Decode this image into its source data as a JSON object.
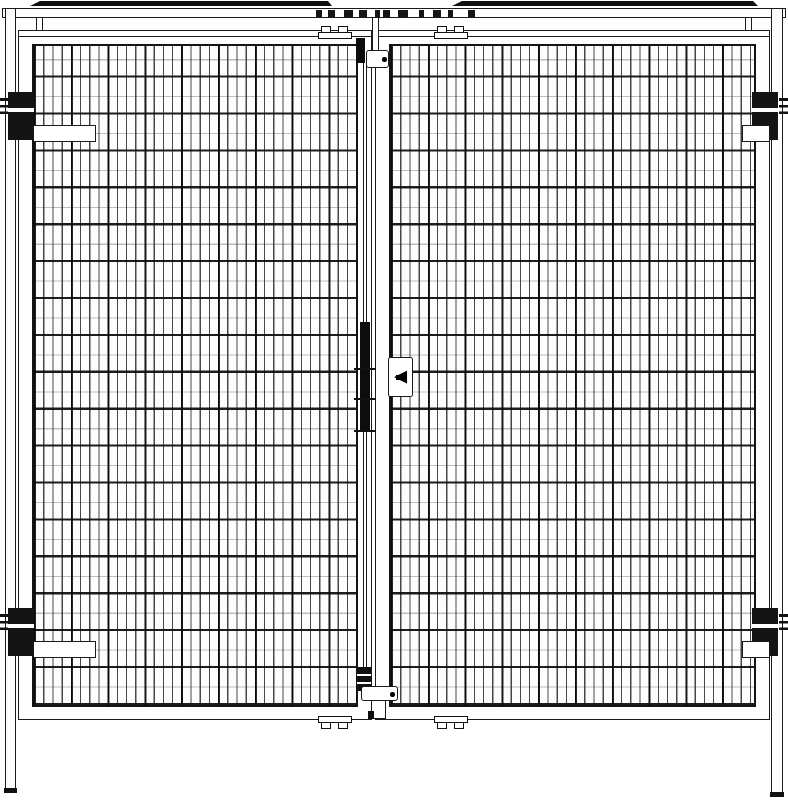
{
  "document": {
    "type": "technical-drawing",
    "subject": "Double-leaf wire mesh safety gate, front elevation",
    "background_color": "#ffffff",
    "line_color": "#1a1a1a",
    "hardware_color": "#111111"
  },
  "annotations": {
    "arrow_plate": {
      "glyph": "◀",
      "direction": "left"
    }
  },
  "components": {
    "header_caps": "top cap bars",
    "header_rail": "header rail with fixing clips",
    "left_post": "left fence post",
    "right_post": "right fence post",
    "left_door": "left mesh door leaf",
    "right_door": "right mesh door leaf",
    "hinges": "4 hinges (2 per side)",
    "lock_rod": "center espagnolette lock rod",
    "top_latch": "top latch keeper",
    "bottom_latch": "bottom latch keeper",
    "mounting_clamps": "top panel clamps",
    "floor_brackets": "bottom panel brackets",
    "arrow_plate": "swing-direction arrow plate"
  }
}
